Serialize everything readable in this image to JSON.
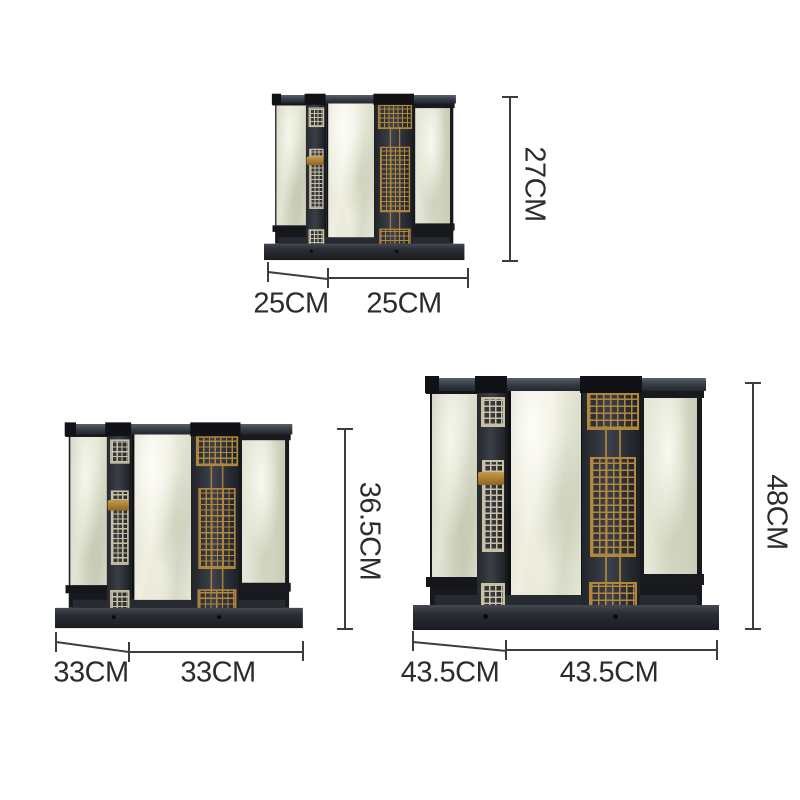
{
  "variants": [
    {
      "name": "small",
      "depth": "25CM",
      "width": "25CM",
      "height": "27CM"
    },
    {
      "name": "medium",
      "depth": "33CM",
      "width": "33CM",
      "height": "36.5CM"
    },
    {
      "name": "large",
      "depth": "43.5CM",
      "width": "43.5CM",
      "height": "48CM"
    }
  ],
  "icons": {
    "fretwork": "greek-key-pattern"
  },
  "colors": {
    "background": "#ffffff",
    "frame_black": "#23262c",
    "marble": "#e8e9da",
    "gold": "#b2873c",
    "pale_gold": "#c9c0a4",
    "dimension_line": "#3d3d3d",
    "label_text": "#2c2c2c"
  }
}
